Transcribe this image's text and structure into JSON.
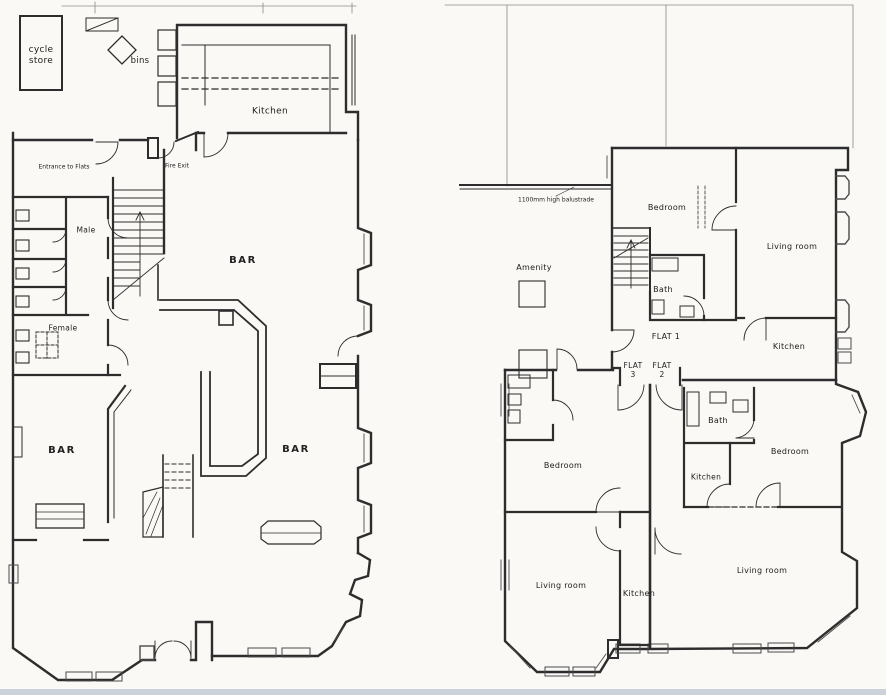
{
  "page": {
    "colors": {
      "ink": "#2d2d2d",
      "paper": "#faf9f6",
      "scanner_strip": "#ccd2da"
    }
  },
  "ground_floor": {
    "title": "ground-floor-plan",
    "labels": {
      "cycle_store": "cycle\nstore",
      "bins": "bins",
      "kitchen": "Kitchen",
      "entrance_to_flats": "Entrance to Flats",
      "fire_exit": "Fire Exit",
      "male": "Male",
      "female": "Female",
      "bar_main": "BAR",
      "bar_left": "BAR",
      "bar_right": "BAR"
    }
  },
  "first_floor": {
    "title": "first-floor-plan",
    "labels": {
      "balustrade_note": "1100mm high balustrade",
      "amenity": "Amenity",
      "bedroom_flat1": "Bedroom",
      "living_room_flat1": "Living room",
      "bath_flat1": "Bath",
      "flat1": "FLAT 1",
      "kitchen_flat1": "Kitchen",
      "flat3": "FLAT\n3",
      "flat2": "FLAT\n2",
      "bath_flat2": "Bath",
      "bedroom_flat2": "Bedroom",
      "kitchen_flat2": "Kitchen",
      "bedroom_flat3": "Bedroom",
      "living_room_flat3": "Living room",
      "kitchen_flat3": "Kitchen",
      "living_room_flat2": "Living room"
    }
  }
}
